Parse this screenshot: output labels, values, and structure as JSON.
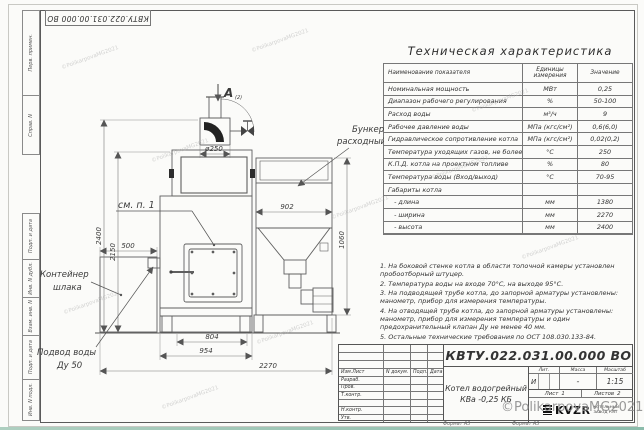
{
  "watermark": {
    "signature": "©PolikarpovaMG2021"
  },
  "margin": {
    "top_cells": [
      "Перв. примен.",
      "Справ. N"
    ],
    "bottom_cells": [
      "Подп. и дата",
      "Инв. N дубл.",
      "Взам. инв. N",
      "Подп. и дата",
      "Инв. N подл."
    ]
  },
  "tech_table": {
    "title": "Техническая характеристика",
    "headers": [
      "Наименование показателя",
      "Единицы измерения",
      "Значение"
    ],
    "rows": [
      [
        "Номинальная мощность",
        "МВт",
        "0,25"
      ],
      [
        "Диапазон рабочего регулирования",
        "%",
        "50-100"
      ],
      [
        "Расход воды",
        "м³/ч",
        "9"
      ],
      [
        "Рабочее давление воды",
        "МПа (кгс/см²)",
        "0,6(6,0)"
      ],
      [
        "Гидравлическое сопротивление котла",
        "МПа (кгс/см²)",
        "0,02(0,2)"
      ],
      [
        "Температура уходящих газов, не более",
        "°С",
        "250"
      ],
      [
        "К.П.Д. котла на проектном топливе",
        "%",
        "80"
      ],
      [
        "Температура воды (Вход/выход)",
        "°С",
        "70-95"
      ],
      [
        "Габариты котла",
        "",
        ""
      ],
      [
        "   - длина",
        "мм",
        "1380"
      ],
      [
        "   - ширина",
        "мм",
        "2270"
      ],
      [
        "   - высота",
        "мм",
        "2400"
      ]
    ]
  },
  "notes": [
    "1. На боковой стенке котла в области топочной камеры установлен пробоотборный штуцер.",
    "2. Температура воды на входе 70°С, на выходе 95°С.",
    "3. На подводящей трубе котла, до запорной арматуры установлены: манометр, прибор для измерения температуры.",
    "4. На отводящей трубе котла, до запорной арматуры установлены: манометр, прибор для измерения температуры и один предохранительный клапан Ду не менее 40 мм.",
    "5. Остальные технические требования по ОСТ 108.030.133-84."
  ],
  "title_block": {
    "doc_number": "КВТУ.022.031.00.000  ВО",
    "header_cols": [
      "Изм.Лист",
      "N докум.",
      "Подп.",
      "Дата"
    ],
    "row_labels": [
      "Разраб.",
      "Пров.",
      "Т.контр.",
      "",
      "Н.контр.",
      "Утв."
    ],
    "product_name_line1": "Котел водогрейный",
    "product_name_line2": "КВа -0,25  КБ",
    "lit_label": "Лит.",
    "mass_label": "Масса",
    "scale_label": "Масштаб",
    "lit_value": "И",
    "mass_value": "-",
    "scale_value": "1:15",
    "sheet_label": "Лист",
    "sheet_value": "1",
    "sheets_label": "Листов",
    "sheets_value": "2",
    "company_logo": "KVZR",
    "company_name_line1": "КОТЕЛЬНЫЙ",
    "company_name_line2": "ЗАВОД  РЭП",
    "format_label": "Формат А3"
  },
  "drawing": {
    "view_label": "А",
    "view_label_sub": "(2)",
    "labels": {
      "diameter": "ø250",
      "see_note": "см. п. 1",
      "bunker_line1": "Бункер",
      "bunker_line2": "расходный",
      "container_line1": "Контейнер",
      "container_line2": "шлака",
      "water_line1": "Подвод воды",
      "water_line2": "Ду 50"
    },
    "dimensions": {
      "height_total": "2400",
      "height_body": "2150",
      "container_width": "500",
      "firebox_width": "804",
      "boiler_width": "954",
      "total_width": "2270",
      "bunker_width": "902",
      "bunker_height": "1060"
    }
  }
}
